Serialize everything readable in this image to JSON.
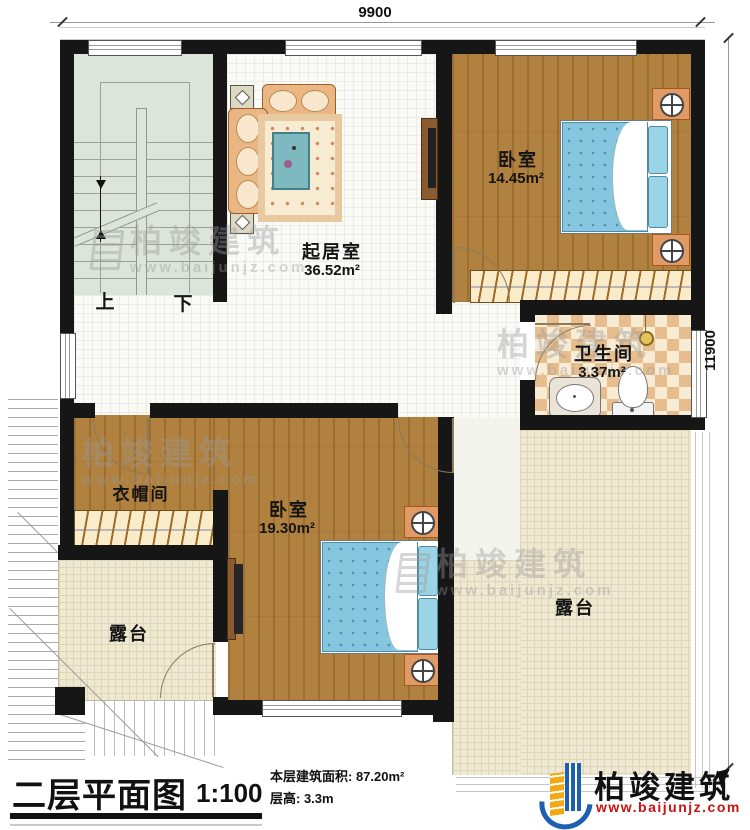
{
  "plan": {
    "title": "二层平面图",
    "scale": "1:100",
    "stats": {
      "area": "本层建筑面积: 87.20m²",
      "floor_height": "层高: 3.3m"
    },
    "dimensions": {
      "width_mm": "9900",
      "height_mm": "11900"
    },
    "rooms": {
      "living": {
        "name": "起居室",
        "area": "36.52m²"
      },
      "bedroom1": {
        "name": "卧室",
        "area": "14.45m²"
      },
      "bathroom": {
        "name": "卫生间",
        "area": "3.37m²"
      },
      "cloakroom": {
        "name": "衣帽间"
      },
      "bedroom2": {
        "name": "卧室",
        "area": "19.30m²"
      },
      "terrace_left": {
        "name": "露台"
      },
      "terrace_right": {
        "name": "露台"
      }
    },
    "stairs": {
      "up": "上",
      "down": "下"
    }
  },
  "branding": {
    "company": "柏竣建筑",
    "website": "www.baijunjz.com"
  },
  "watermark": {
    "company": "柏竣建筑",
    "website": "www.baijunjz.com"
  },
  "colors": {
    "wall": "#161616",
    "wood_floor": "#b0813f",
    "stair_floor": "#dde4da",
    "terrace_floor": "#efe9d3",
    "tile_tan": "#e7bd8d",
    "bed_blue": "#86c6de",
    "accent_orange": "#e09a66",
    "logo_blue": "#1d5fb0",
    "logo_yellow": "#f3a712",
    "url_red": "#cc1111"
  }
}
